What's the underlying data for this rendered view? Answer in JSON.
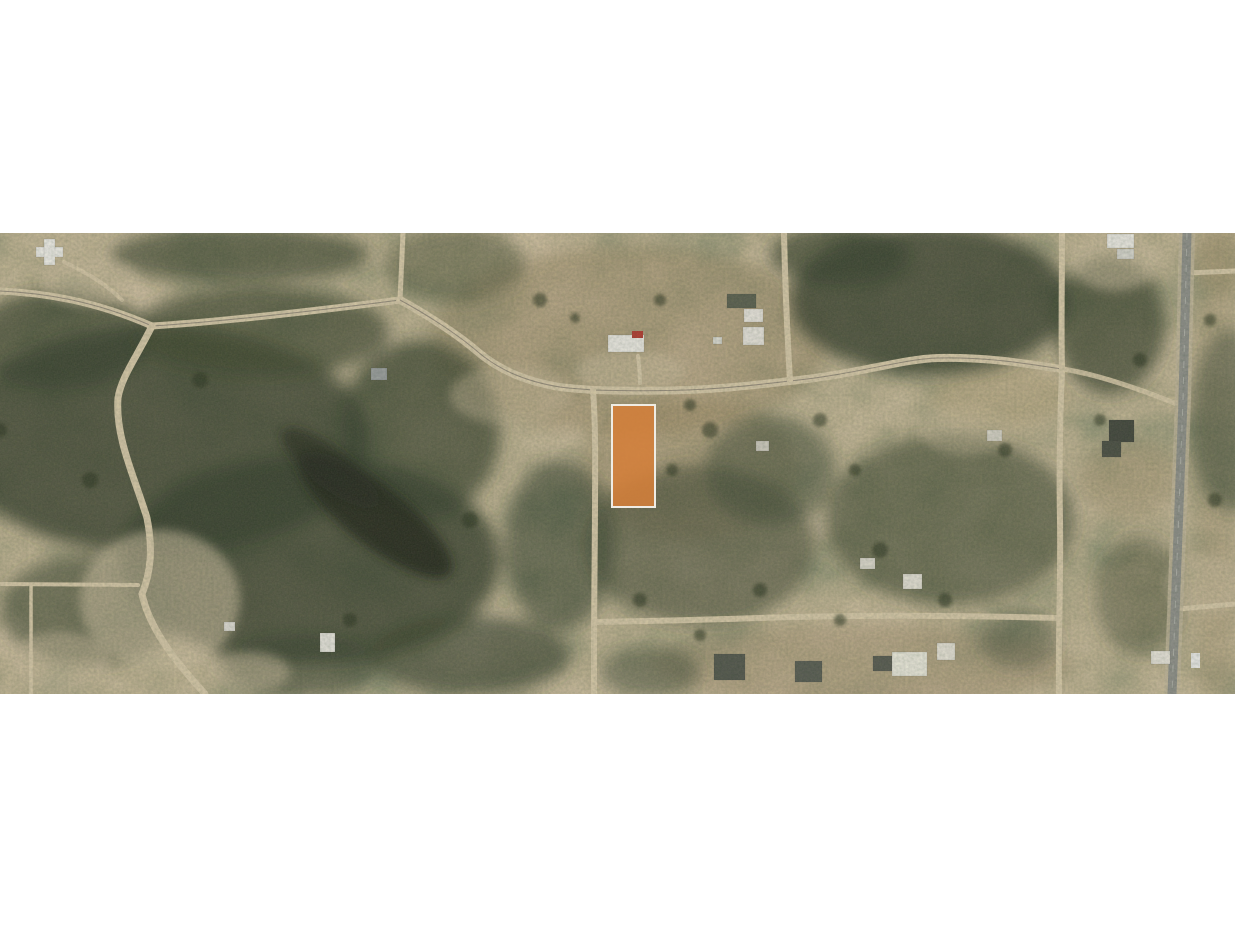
{
  "page": {
    "background_color": "#ffffff",
    "content_description": "Aerial satellite photo strip with one land parcel highlighted in orange"
  },
  "photo": {
    "kind": "satellite-aerial-imagery",
    "parcel": {
      "highlight_color": "#d4803a",
      "border_color": "#efece4",
      "x": "612",
      "y": "405",
      "width": "43",
      "height": "102"
    },
    "palette": {
      "terrain_base": "#857649",
      "forest": "#333f2b",
      "marsh": "#20261b",
      "brush": "#9b8a66",
      "dirt_road": "#d9ccab",
      "paved_road": "#8e918b",
      "roof_white": "#efefe8",
      "roof_dark": "#50564c",
      "car_red": "#b3392e"
    }
  }
}
